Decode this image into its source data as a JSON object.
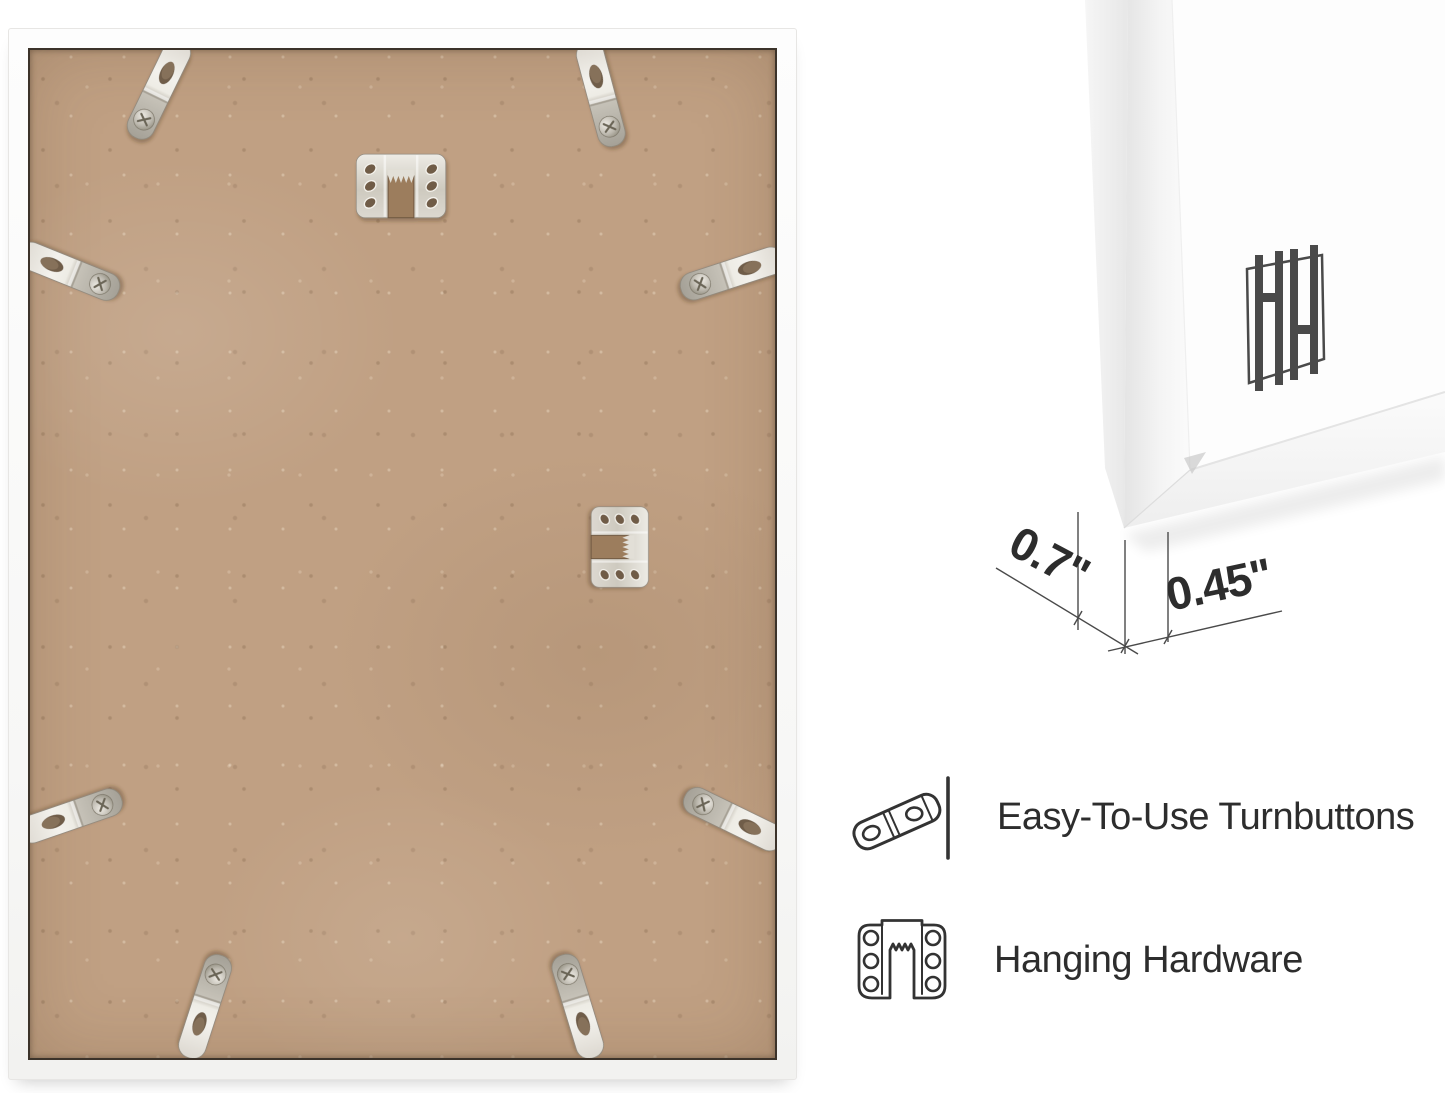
{
  "background_color": "#ffffff",
  "back_view": {
    "description": "Back of picture frame with MDF backing board",
    "board_color": "#c0a083",
    "frame_color": "#fafafa",
    "turnbutton_count": 8,
    "sawtooth_hanger_count": 2
  },
  "corner_detail": {
    "logo_mark": "HH",
    "dimensions": {
      "depth_label": "0.7\"",
      "face_label": "0.45\""
    }
  },
  "features": [
    {
      "icon": "turnbutton-icon",
      "label": "Easy-To-Use Turnbuttons"
    },
    {
      "icon": "hanging-hardware-icon",
      "label": "Hanging Hardware"
    }
  ],
  "annotation_color": "#2d2d2d",
  "metal_color": "#d9d6cf"
}
